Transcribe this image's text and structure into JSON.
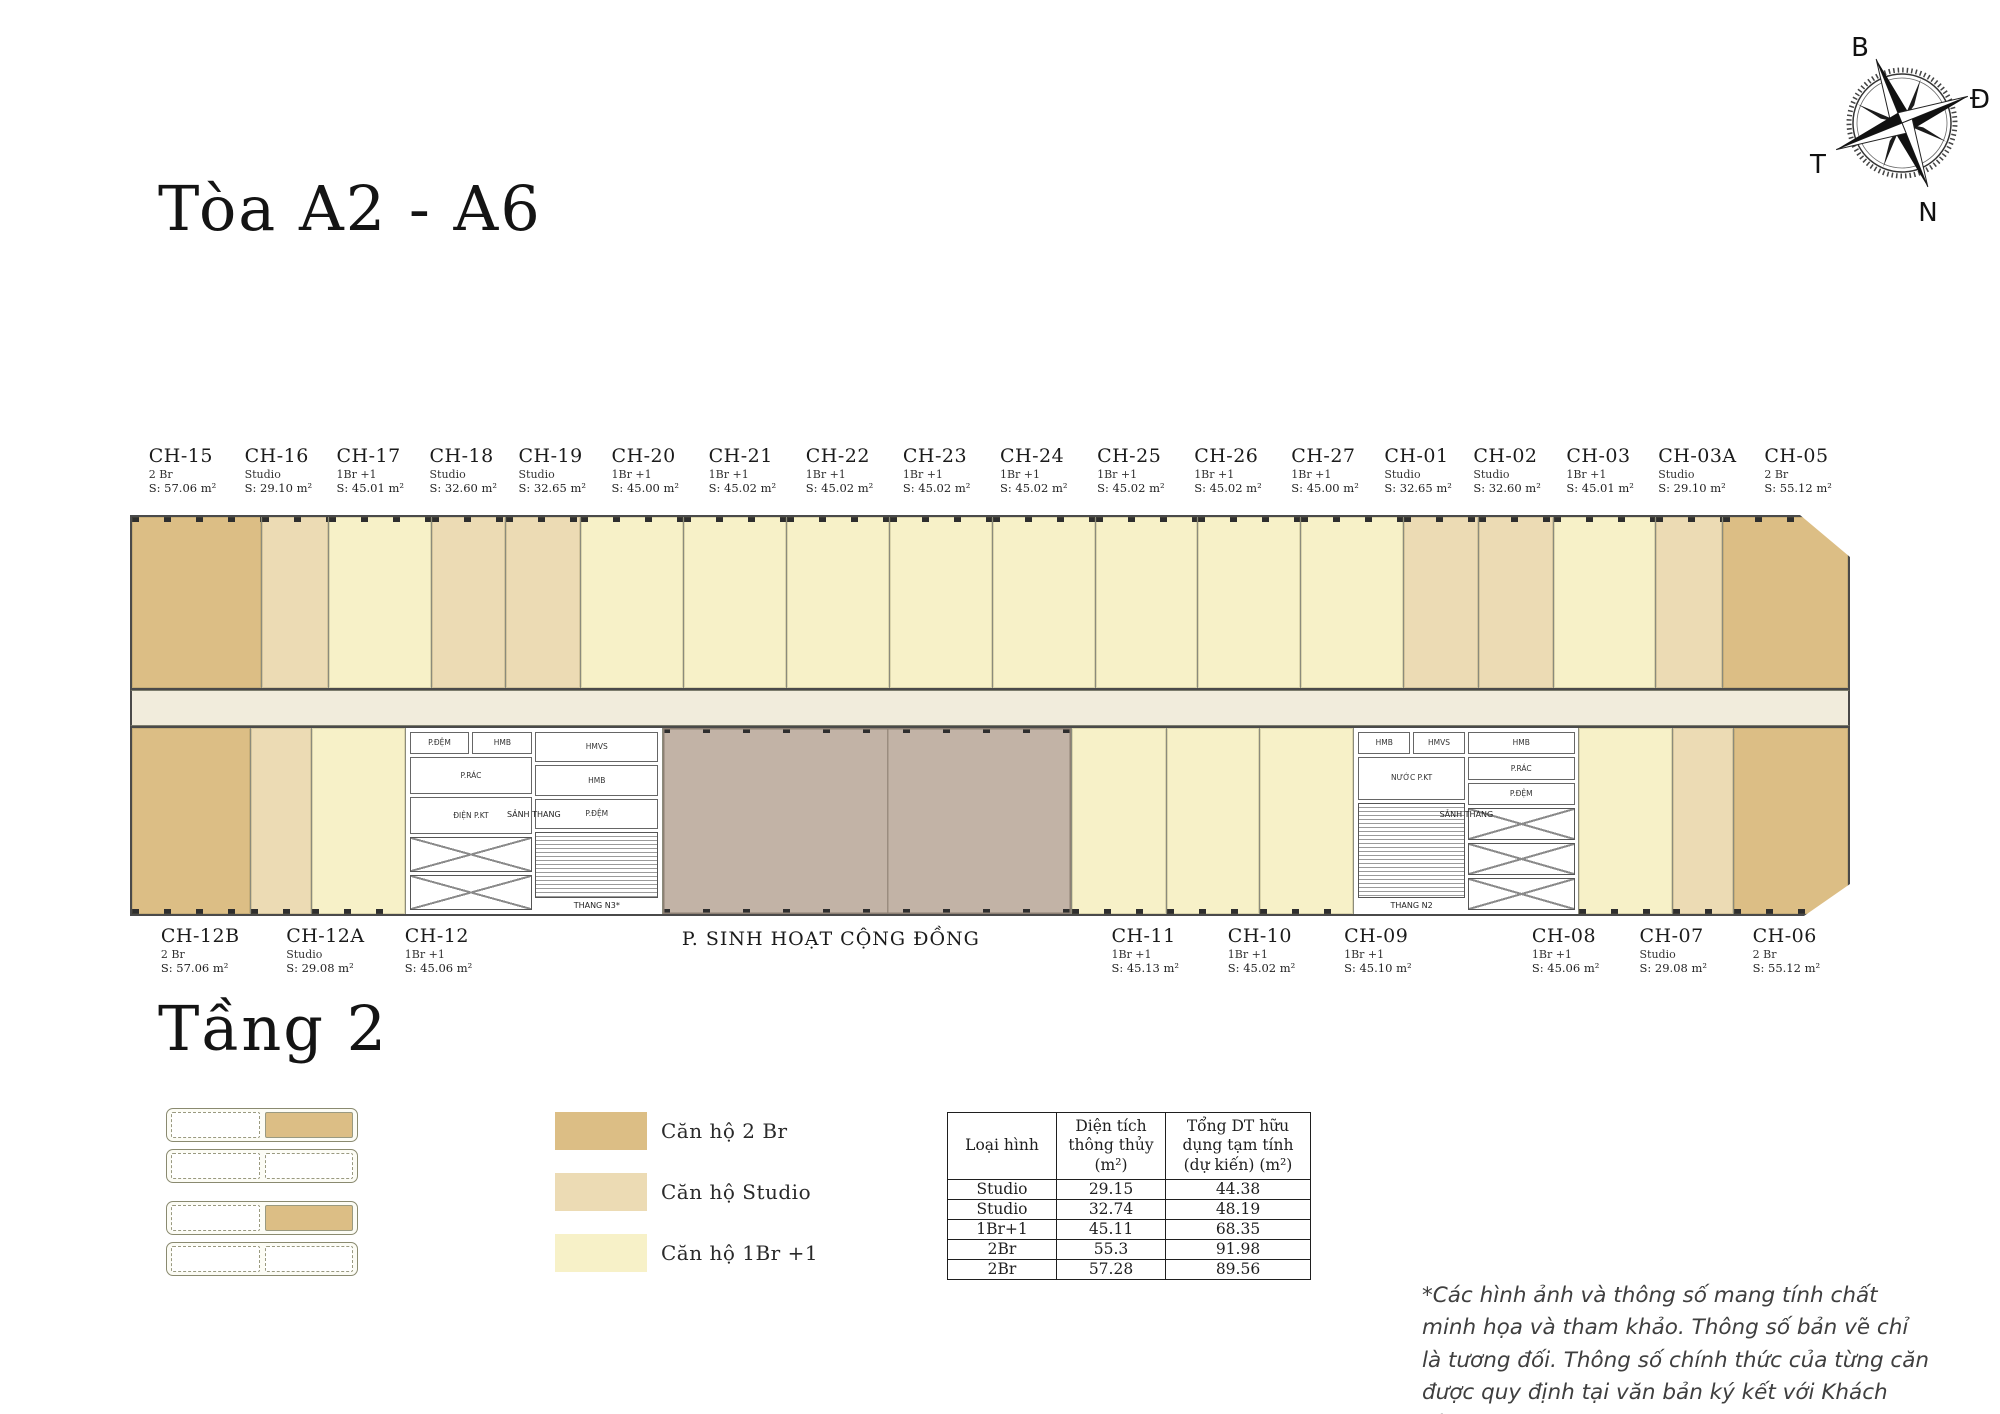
{
  "page": {
    "title": "Tòa A2 - A6",
    "floor_title": "Tầng 2"
  },
  "compass": {
    "north_label": "B",
    "east_label": "Đ",
    "south_label": "N",
    "west_label": "T"
  },
  "top_units": [
    {
      "id": "CH-15",
      "type": "2 Br",
      "area": "S: 57.06 m²",
      "m2": 57.06
    },
    {
      "id": "CH-16",
      "type": "Studio",
      "area": "S: 29.10 m²",
      "m2": 29.1
    },
    {
      "id": "CH-17",
      "type": "1Br +1",
      "area": "S: 45.01 m²",
      "m2": 45.01
    },
    {
      "id": "CH-18",
      "type": "Studio",
      "area": "S: 32.60 m²",
      "m2": 32.6
    },
    {
      "id": "CH-19",
      "type": "Studio",
      "area": "S: 32.65 m²",
      "m2": 32.65
    },
    {
      "id": "CH-20",
      "type": "1Br +1",
      "area": "S: 45.00 m²",
      "m2": 45.0
    },
    {
      "id": "CH-21",
      "type": "1Br +1",
      "area": "S: 45.02 m²",
      "m2": 45.02
    },
    {
      "id": "CH-22",
      "type": "1Br +1",
      "area": "S: 45.02 m²",
      "m2": 45.02
    },
    {
      "id": "CH-23",
      "type": "1Br +1",
      "area": "S: 45.02 m²",
      "m2": 45.02
    },
    {
      "id": "CH-24",
      "type": "1Br +1",
      "area": "S: 45.02 m²",
      "m2": 45.02
    },
    {
      "id": "CH-25",
      "type": "1Br +1",
      "area": "S: 45.02 m²",
      "m2": 45.02
    },
    {
      "id": "CH-26",
      "type": "1Br +1",
      "area": "S: 45.02 m²",
      "m2": 45.02
    },
    {
      "id": "CH-27",
      "type": "1Br +1",
      "area": "S: 45.00 m²",
      "m2": 45.0
    },
    {
      "id": "CH-01",
      "type": "Studio",
      "area": "S: 32.65 m²",
      "m2": 32.65
    },
    {
      "id": "CH-02",
      "type": "Studio",
      "area": "S: 32.60 m²",
      "m2": 32.6
    },
    {
      "id": "CH-03",
      "type": "1Br +1",
      "area": "S: 45.01 m²",
      "m2": 45.01
    },
    {
      "id": "CH-03A",
      "type": "Studio",
      "area": "S: 29.10 m²",
      "m2": 29.1
    },
    {
      "id": "CH-05",
      "type": "2 Br",
      "area": "S: 55.12 m²",
      "m2": 55.12
    }
  ],
  "bottom_segments": [
    {
      "kind": "unit",
      "id": "CH-12B",
      "type": "2 Br",
      "area": "S: 57.06 m²",
      "m2": 57.06
    },
    {
      "kind": "unit",
      "id": "CH-12A",
      "type": "Studio",
      "area": "S: 29.08 m²",
      "m2": 29.08
    },
    {
      "kind": "unit",
      "id": "CH-12",
      "type": "1Br +1",
      "area": "S: 45.06 m²",
      "m2": 45.06
    },
    {
      "kind": "core",
      "side": "left"
    },
    {
      "kind": "community"
    },
    {
      "kind": "unit",
      "id": "CH-11",
      "type": "1Br +1",
      "area": "S: 45.13 m²",
      "m2": 45.13
    },
    {
      "kind": "unit",
      "id": "CH-10",
      "type": "1Br +1",
      "area": "S: 45.02 m²",
      "m2": 45.02
    },
    {
      "kind": "unit",
      "id": "CH-09",
      "type": "1Br +1",
      "area": "S: 45.10 m²",
      "m2": 45.1
    },
    {
      "kind": "core",
      "side": "right"
    },
    {
      "kind": "unit",
      "id": "CH-08",
      "type": "1Br +1",
      "area": "S: 45.06 m²",
      "m2": 45.06
    },
    {
      "kind": "unit",
      "id": "CH-07",
      "type": "Studio",
      "area": "S: 29.08 m²",
      "m2": 29.08
    },
    {
      "kind": "unit",
      "id": "CH-06",
      "type": "2 Br",
      "area": "S: 55.12 m²",
      "m2": 55.12
    }
  ],
  "community_label": "P. SINH HOẠT CỘNG ĐỒNG",
  "cores": {
    "left": {
      "rooms_a": [
        "P.ĐỆM",
        "HMB",
        "P.RÁC",
        "ĐIỆN P.KT"
      ],
      "rooms_b": [
        "HMVS",
        "HMB",
        "P.ĐỆM"
      ],
      "lobby": "SẢNH THANG",
      "stair": "THANG N3*",
      "elevators": 2
    },
    "right": {
      "rooms_a": [
        "HMB",
        "HMVS",
        "NƯỚC P.KT"
      ],
      "rooms_b": [
        "HMB",
        "P.RÁC",
        "P.ĐỆM"
      ],
      "lobby": "SẢNH THANG",
      "stair": "THANG N2",
      "elevators": 3
    }
  },
  "unit_colors": {
    "2 Br": "#dcbe85",
    "Studio": "#ecdbb4",
    "1Br +1": "#f7f1c8"
  },
  "plan_colors": {
    "corridor": "#f1ecdc",
    "community": "#c2b3a6",
    "core": "#ffffff",
    "outline": "#4a4a4a"
  },
  "legend": {
    "items": [
      {
        "label": "Căn hộ 2 Br",
        "type": "2 Br"
      },
      {
        "label": "Căn hộ Studio",
        "type": "Studio"
      },
      {
        "label": "Căn hộ 1Br +1",
        "type": "1Br +1"
      }
    ]
  },
  "table": {
    "headers": [
      "Loại hình",
      "Diện tích\nthông thủy\n(m²)",
      "Tổng DT hữu\ndụng tạm tính\n(dự kiến) (m²)"
    ],
    "rows": [
      [
        "Studio",
        "29.15",
        "44.38"
      ],
      [
        "Studio",
        "32.74",
        "48.19"
      ],
      [
        "1Br+1",
        "45.11",
        "68.35"
      ],
      [
        "2Br",
        "55.3",
        "91.98"
      ],
      [
        "2Br",
        "57.28",
        "89.56"
      ]
    ]
  },
  "disclaimer": "*Các hình ảnh và thông số mang tính chất minh họa và tham khảo. Thông số bản vẽ chỉ là tương đối. Thông số chính thức của từng căn được quy định tại văn bản ký kết với Khách hàng*"
}
